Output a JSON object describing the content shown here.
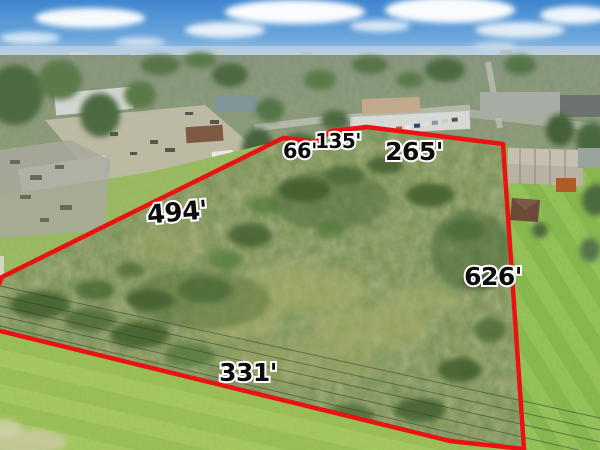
{
  "photo": {
    "description": "aerial drone photo of a vacant land parcel outlined in red with lot dimension labels",
    "boundary_color": "#ea1212",
    "label_text_color": "#0d0d0d",
    "label_outline_color": "#ffffff"
  },
  "dimensions": {
    "west": "494'",
    "north_left": "66'",
    "north_middle": "135'",
    "north_right": "265'",
    "east": "626'",
    "south": "331'"
  }
}
